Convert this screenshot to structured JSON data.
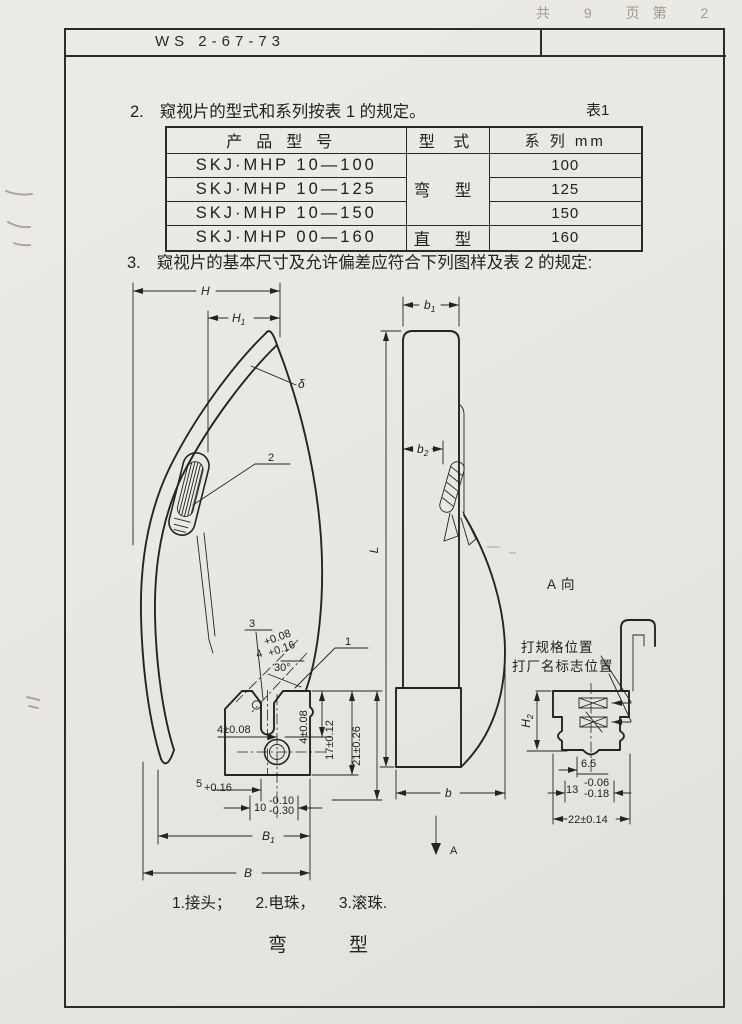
{
  "page": {
    "handwritten_note": "共 9 页第 2 页",
    "doc_number": "WS 2-67-73"
  },
  "section2": {
    "number": "2.",
    "text": "窥视片的型式和系列按表 1 的规定。",
    "table_label": "表1"
  },
  "table1": {
    "col_model": "产品型号",
    "col_type": "型 式",
    "col_series": "系 列 mm",
    "rows": [
      {
        "model": "SKJ·MHP 10—100",
        "series": "100"
      },
      {
        "model": "SKJ·MHP 10—125",
        "series": "125"
      },
      {
        "model": "SKJ·MHP 10—150",
        "series": "150"
      },
      {
        "model": "SKJ·MHP 00—160",
        "series": "160"
      }
    ],
    "type_bent": "弯 型",
    "type_straight": "直 型"
  },
  "section3": {
    "number": "3.",
    "text": "窥视片的基本尺寸及允许偏差应符合下列图样及表 2 的规定:"
  },
  "drawing": {
    "left": {
      "H": "H",
      "H1_base": "H",
      "H1_sub": "1",
      "delta": "δ",
      "part2": "2",
      "part3": "3",
      "part1": "1",
      "slot_base": "4",
      "slot_sup": "+0.08",
      "slot_sub": "+0.16",
      "angle": "30°",
      "d4_left": "4±0.08",
      "d4_right": "4±0.08",
      "d17": "17±0.12",
      "d21": "21±0.26",
      "d5_base": "5",
      "d5_sub": "+0.16",
      "d10_base": "10",
      "d10_sup": "-0.10",
      "d10_sub": "-0.30",
      "B1_base": "B",
      "B1_sub": "1",
      "B": "B"
    },
    "middle": {
      "b1_base": "b",
      "b1_sub": "1",
      "b2_base": "b",
      "b2_sub": "2",
      "L": "L",
      "b": "b",
      "A": "A"
    },
    "right": {
      "view_title": "A 向",
      "stamp_spec_note": "打规格位置",
      "stamp_name_note": "打厂名标志位置",
      "H2_base": "H",
      "H2_sub": "2",
      "d65": "6.5",
      "d13_base": "13",
      "d13_sup": "-0.06",
      "d13_sub": "-0.18",
      "d22": "22±0.14"
    }
  },
  "legend": {
    "item1": "1.接头；",
    "item2": "2.电珠，",
    "item3": "3.滚珠."
  },
  "caption": {
    "char1": "弯",
    "char2": "型"
  }
}
